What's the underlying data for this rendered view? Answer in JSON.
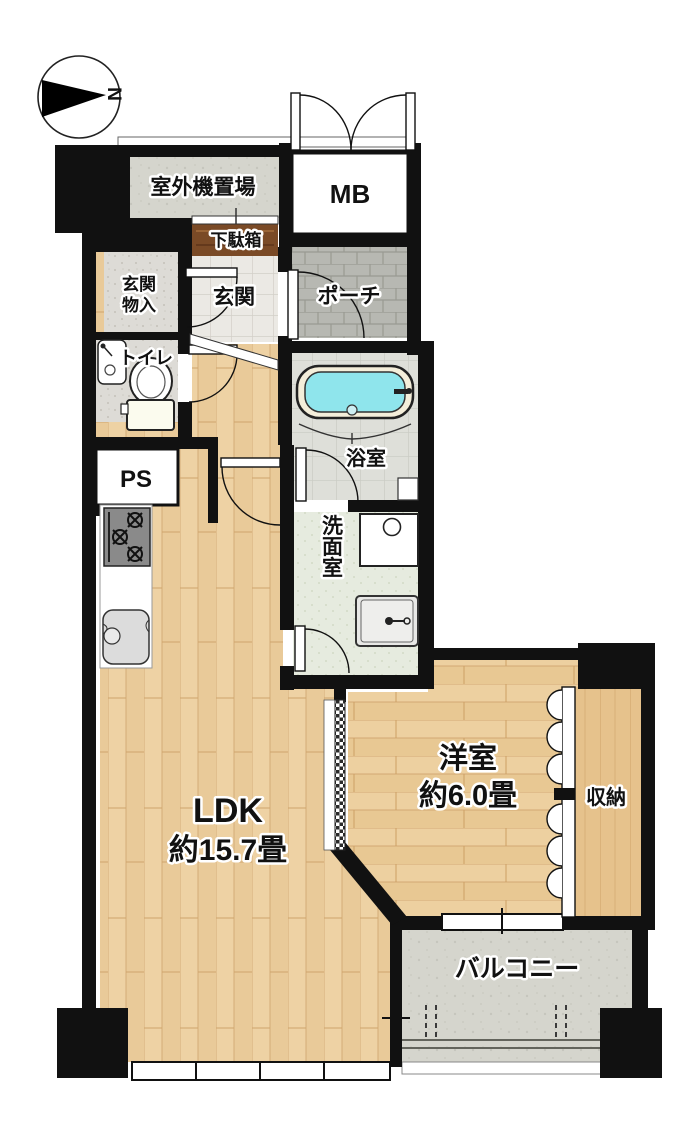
{
  "compass": {
    "north_label": "N"
  },
  "rooms": {
    "outdoor_unit": "室外機置場",
    "meter_box": "MB",
    "shoe_cabinet": "下駄箱",
    "entrance_storage": [
      "玄関",
      "物入"
    ],
    "entrance": "玄関",
    "porch": "ポーチ",
    "toilet": "トイレ",
    "bathroom": "浴室",
    "pipe_space": "PS",
    "washroom": "洗面室",
    "ldk": [
      "LDK",
      "約15.7畳"
    ],
    "western_room": [
      "洋室",
      "約6.0畳"
    ],
    "storage": "収納",
    "balcony": "バルコニー"
  },
  "colors": {
    "wall": "#111111",
    "ldk_wood": "#eed2a4",
    "storage_wood": "#e6c28c",
    "shoe_cabinet_wood": "#7a4a26",
    "bath_water": "#8fe5ec",
    "tub_rim": "#f4eeda",
    "concrete": "#d5d5cd",
    "porch_tile": "#b7b8b2",
    "entrance_tile": "#ebe9e4",
    "speckle_tile": "#dddbd6",
    "washroom_floor": "#e6ebdf",
    "bath_tile": "#dedfd9"
  }
}
